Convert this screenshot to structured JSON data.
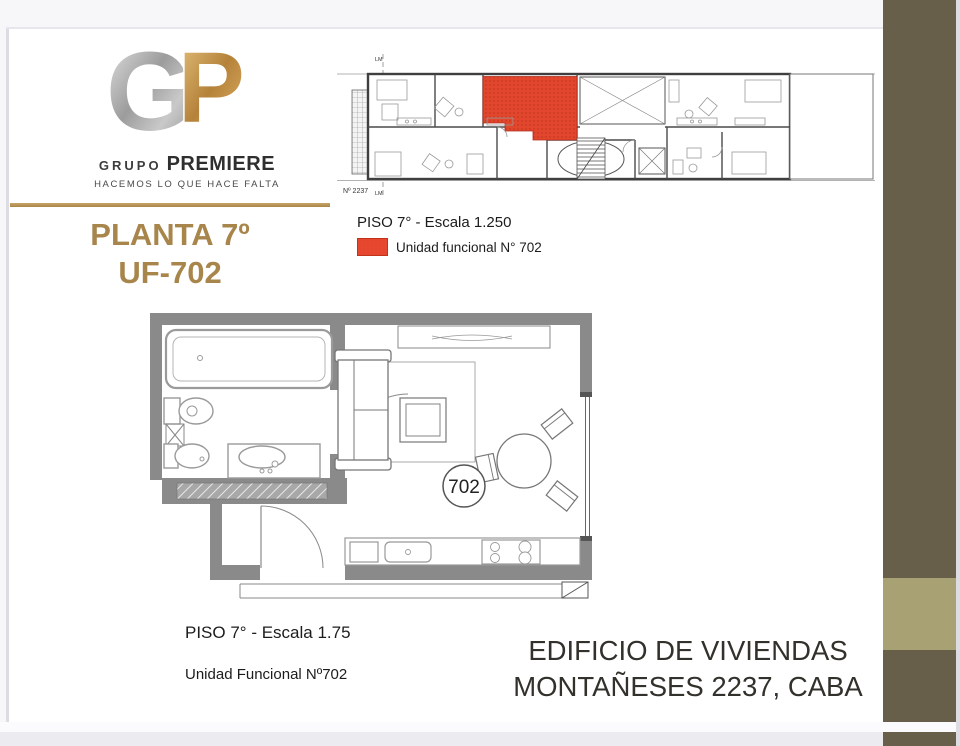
{
  "slide": {
    "accent_gold": "#A8854B",
    "sidebar_dark": "#675F4A",
    "sidebar_light": "#A8A173",
    "highlight_red": "#E8472F"
  },
  "logo": {
    "letter_g": "G",
    "letter_p": "P",
    "name_part1": "GRUPO",
    "name_part2": "PREMIERE",
    "tagline": "HACEMOS LO QUE HACE FALTA"
  },
  "title": {
    "line1": "PLANTA 7º",
    "line2": "UF-702"
  },
  "floor_overview": {
    "caption": "PISO 7° - Escala 1.250",
    "legend_label": "Unidad funcional N° 702",
    "street_number": "Nº 2237",
    "lm_top": "LM",
    "lm_bottom": "LM"
  },
  "unit_plan": {
    "unit_number": "702",
    "caption": "PISO 7° - Escala 1.75",
    "subcaption": "Unidad Funcional Nº702"
  },
  "footer": {
    "line1": "EDIFICIO DE VIVIENDAS",
    "line2": "MONTAÑESES 2237, CABA"
  }
}
